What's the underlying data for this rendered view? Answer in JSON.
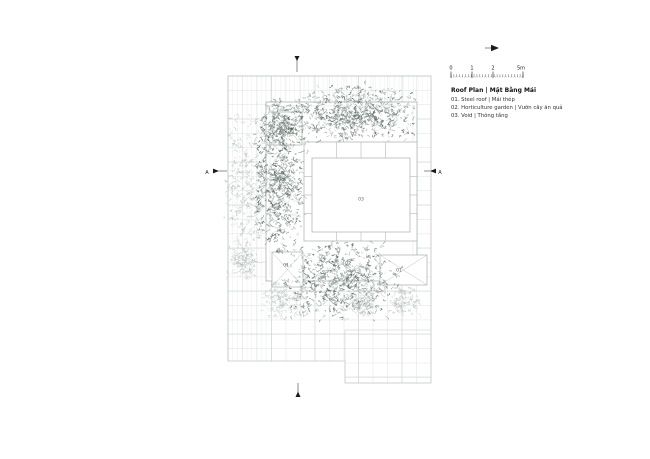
{
  "legend": {
    "title": "Roof Plan | Mặt Bằng Mái",
    "items": [
      "01. Steel roof | Mái thép",
      "02. Horticulture garden | Vườn cây ăn quả",
      "03. Void | Thông tầng"
    ]
  },
  "scale_bar": {
    "labels": [
      "0",
      "1",
      "2",
      "5m"
    ]
  },
  "plan": {
    "labels": [
      "01",
      "02",
      "03",
      "01",
      "02",
      "01"
    ],
    "section_label": "A",
    "colors": {
      "background": "#ffffff",
      "grid_fine": "#e6eae7",
      "grid": "#dbe0dd",
      "grid_major": "#cbd2ce",
      "outline": "#bfc7c2",
      "planter_line": "#a9b3ad",
      "void_line": "#b2bab4",
      "panel_line": "#a5afa9",
      "panel_diag": "#bcc5bf",
      "label": "#6b6055",
      "marker": "#1a1a1a",
      "text": "#1a1a1a",
      "veg_dark": [
        "#3d4d45",
        "#56665e",
        "#74837b",
        "#95a19b"
      ],
      "veg_light": [
        "#aeb9b3",
        "#bfc8c3",
        "#ccd3cf"
      ]
    },
    "vegetation": [
      {
        "x": 296,
        "y": 86,
        "w": 118,
        "h": 56,
        "density": 650,
        "tone": "dark",
        "seed": 11
      },
      {
        "x": 258,
        "y": 100,
        "w": 46,
        "h": 52,
        "density": 280,
        "tone": "dark",
        "seed": 22
      },
      {
        "x": 254,
        "y": 130,
        "w": 50,
        "h": 122,
        "density": 560,
        "tone": "dark",
        "seed": 33
      },
      {
        "x": 226,
        "y": 112,
        "w": 36,
        "h": 160,
        "density": 300,
        "tone": "light",
        "seed": 44
      },
      {
        "x": 286,
        "y": 244,
        "w": 112,
        "h": 74,
        "density": 680,
        "tone": "dark",
        "seed": 55
      },
      {
        "x": 228,
        "y": 244,
        "w": 30,
        "h": 38,
        "density": 120,
        "tone": "light",
        "seed": 66
      },
      {
        "x": 262,
        "y": 282,
        "w": 42,
        "h": 36,
        "density": 160,
        "tone": "light",
        "seed": 77
      },
      {
        "x": 348,
        "y": 290,
        "w": 32,
        "h": 28,
        "density": 110,
        "tone": "light",
        "seed": 88
      },
      {
        "x": 390,
        "y": 286,
        "w": 30,
        "h": 28,
        "density": 110,
        "tone": "light",
        "seed": 99
      }
    ]
  }
}
